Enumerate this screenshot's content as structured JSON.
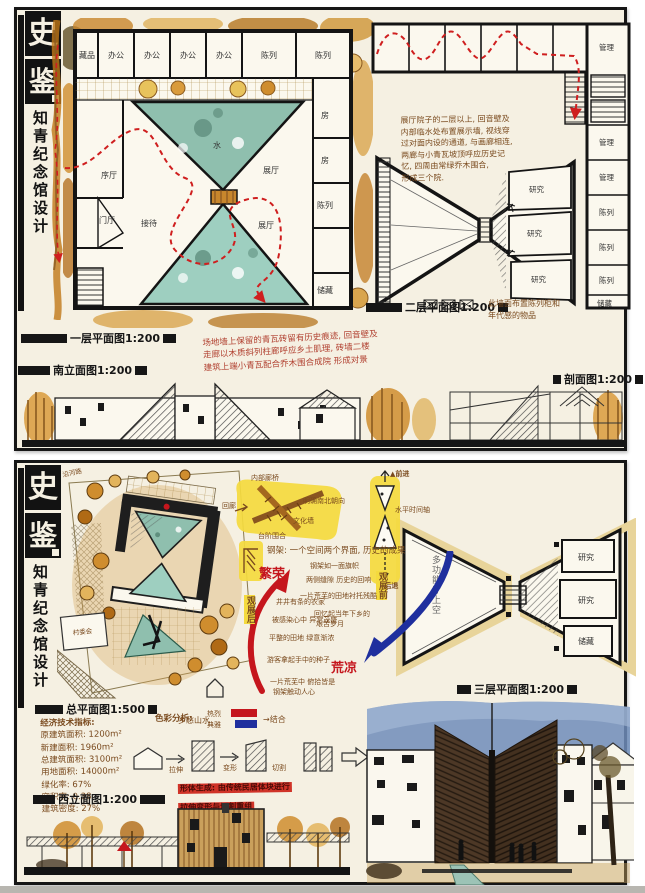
{
  "colors": {
    "paper": "#f5f0e2",
    "ink": "#161616",
    "hand_brown": "#7a4a1e",
    "note_red": "#b14030",
    "circulation_red": "#cf1f1f",
    "arrow_red": "#c5161d",
    "arrow_blue": "#1f2f9e",
    "highlight_yellow": "#f4da3e",
    "water_teal": "#8fbfae",
    "tree_orange": "#cf8d2e"
  },
  "b1": {
    "logo_top": "史",
    "logo_bottom": "鉴",
    "title_vertical": "知青纪念馆设计",
    "plan1_label": "一层平面图1:200",
    "plan1_rooms_top": [
      "藏品",
      "办公",
      "办公",
      "办公",
      "办公",
      "陈列",
      "陈列"
    ],
    "plan1_rooms_right": [
      "房",
      "房",
      "陈列",
      "储藏"
    ],
    "plan1_rooms_inner": {
      "xu": "序厅",
      "shui": "水",
      "zhan1": "展厅",
      "zhan2": "展厅",
      "jiedai": "接待",
      "men": "门厅"
    },
    "plan2_label": "二层平面图1:200",
    "plan2_rooms_right": [
      "管理",
      "管理",
      "管理",
      "陈列",
      "陈列",
      "陈列",
      "储藏"
    ],
    "plan2_rooms_mid": [
      "研究",
      "研究",
      "研究"
    ],
    "plan2_note": [
      "展厅院子的二层以上, 回音壁及",
      "内部临水处布置展示墙, 视线穿",
      "过对面内设的通道, 与画廊相连,",
      "两廊与小青瓦坡顶呼应历史记",
      "忆, 四周由常绿乔木围合,",
      "形成三个院."
    ],
    "note_right": [
      "此墙面布置陈列柜和",
      "年代感的物品"
    ],
    "note_red": [
      "场地墙上保留的青瓦砖留有历史痕迹, 回音壁及",
      "走廊以木质斜列柱廊呼应乡土肌理, 砖墙二楼",
      "建筑上端小青瓦配合乔木围合成院 形成对景"
    ],
    "south_elev_label": "南立面图1:200",
    "section_label": "剖面图1:200"
  },
  "b2": {
    "logo_top": "史",
    "logo_bottom": "鉴",
    "title_vertical": "知青纪念馆设计",
    "site_label": "总平面图1:500",
    "site_road": "沿河路",
    "site_neighbor": "村委会",
    "ind_title": "经济技术指标:",
    "ind": [
      "原建筑面积: 1200m²",
      "新建面积: 1960m²",
      "总建筑面积: 3100m²",
      "用地面积: 14000m²",
      "绿化率: 67%",
      "容积率: 0.38",
      "建筑密度: 27%"
    ],
    "west_elev_label": "西立面图1:200",
    "plan3_label": "三层平面图1:200",
    "plan3_left_room": "多功能厅上空",
    "plan3_rooms": [
      "研究",
      "研究",
      "储藏"
    ],
    "diag1_labels": [
      "内部廊桥",
      "回廊",
      "明确南北朝向",
      "文化墙",
      "台阶围合"
    ],
    "diag2_top": "▲前进",
    "diag2_mid": "水平时间轴",
    "diag2_bottom": "▼后退",
    "concept_line": "钢架: 一个空间两个界面, 历史的成果",
    "red_arrow_label": "繁荣",
    "red_arrow_side": "观展后",
    "red_notes": [
      "井井有条的农家",
      "被感染心中 异常茂盛",
      "平整的田地 绿意渐浓",
      "游客拿起手中的种子",
      "一片荒芜中 俯拾皆是",
      "钢架触动人心"
    ],
    "blue_arrow_label": "荒凉",
    "blue_arrow_side": "观展前",
    "blue_notes": [
      "钢架如一面旗帜",
      "两侧缝隙 历史的回响",
      "一片荒芜的田地衬托残酷",
      "回忆起当年下乡的",
      "艰苦岁月"
    ],
    "color_label": "色彩分析:",
    "color_item": "乡愁山水",
    "color_red": "热烈",
    "color_blue": "典雅",
    "color_result": "→结合",
    "massing_steps": [
      "拉伸",
      "变形",
      "切割"
    ],
    "massing_note": [
      "形体生成: 由传统民居体块进行",
      "拉伸变形与切割重组"
    ]
  }
}
